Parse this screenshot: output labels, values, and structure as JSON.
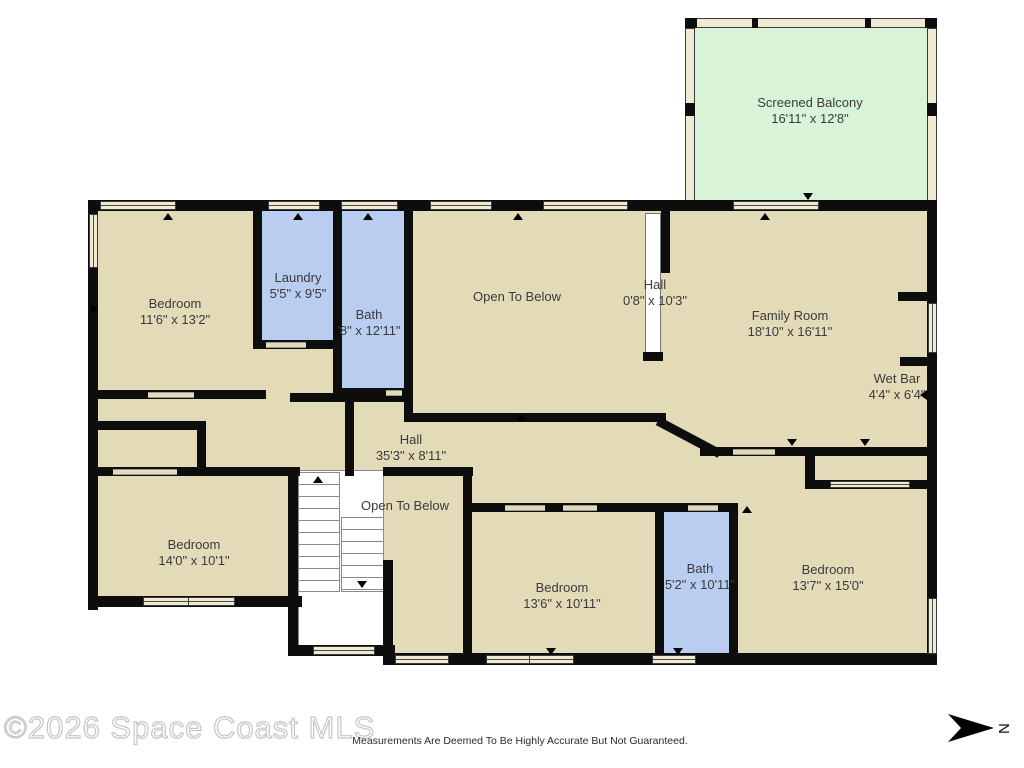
{
  "plan": {
    "balcony": {
      "name": "Screened Balcony",
      "dims": "16'11\" x 12'8\""
    },
    "rooms": {
      "bedroom_top_left": {
        "name": "Bedroom",
        "dims": "11'6\" x 13'2\""
      },
      "laundry": {
        "name": "Laundry",
        "dims": "5'5\" x 9'5\""
      },
      "bath_top": {
        "name": "Bath",
        "dims": "'8\" x 12'11\""
      },
      "open_below_top": {
        "name": "Open To Below",
        "dims": ""
      },
      "hall_small": {
        "name": "Hall",
        "dims": "0'8\" x 10'3\""
      },
      "family_room": {
        "name": "Family Room",
        "dims": "18'10\" x 16'11\""
      },
      "wet_bar": {
        "name": "Wet Bar",
        "dims": "4'4\" x 6'4\""
      },
      "hall_main": {
        "name": "Hall",
        "dims": "35'3\" x 8'11\""
      },
      "bedroom_left": {
        "name": "Bedroom",
        "dims": "14'0\" x 10'1\""
      },
      "open_below_stairs": {
        "name": "Open To Below",
        "dims": ""
      },
      "bedroom_bottom_center": {
        "name": "Bedroom",
        "dims": "13'6\" x 10'11\""
      },
      "bath_bottom": {
        "name": "Bath",
        "dims": "5'2\" x 10'11\""
      },
      "bedroom_bottom_right": {
        "name": "Bedroom",
        "dims": "13'7\" x 15'0\""
      }
    },
    "colors": {
      "room_fill": "#e3dab8",
      "wet_room_fill": "#b9cdf1",
      "balcony_fill": "#d8f3d8",
      "wall": "#0d0d0d",
      "window_fill": "#f1ead3"
    }
  },
  "footer": {
    "watermark": "©2026 Space Coast MLS",
    "disclaimer": "Measurements Are Deemed To Be Highly Accurate But Not Guaranteed.",
    "north_label": "N"
  }
}
